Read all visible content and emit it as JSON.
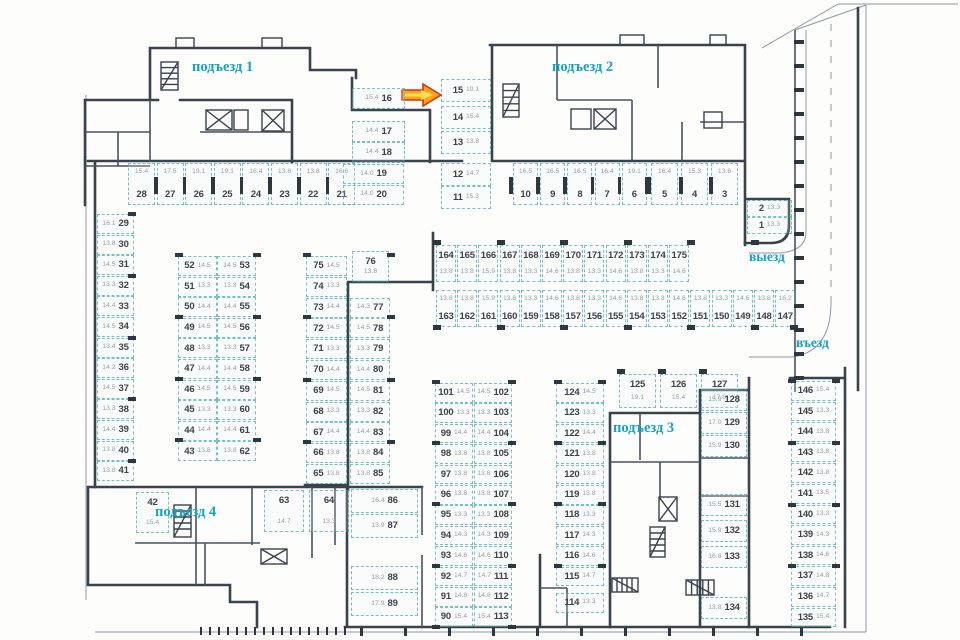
{
  "labels": {
    "entrance1": "подъезд 1",
    "entrance2": "подъезд 2",
    "entrance3": "подъезд 3",
    "entrance4": "подъезд 4",
    "exit": "выезд",
    "entry": "въезд"
  },
  "colors": {
    "wall": "#3a424e",
    "spot_border": "rgba(38,160,164,.62)",
    "spot_number": "#3e434b",
    "spot_area": "#99a0a8",
    "label": "#14a3c8",
    "arrow_fill": "#ffa21f",
    "arrow_stroke": "#d03a10"
  },
  "spot_groups": {
    "row_28_21": [
      {
        "n": "28",
        "a": "15.4"
      },
      {
        "n": "27",
        "a": "17.5"
      },
      {
        "n": "26",
        "a": "19.1"
      },
      {
        "n": "25",
        "a": "19.1"
      },
      {
        "n": "24",
        "a": "16.4"
      },
      {
        "n": "23",
        "a": "13.8"
      },
      {
        "n": "22",
        "a": "13.8"
      },
      {
        "n": "21",
        "a": "16.6"
      }
    ],
    "col_16_18": [
      {
        "n": "16",
        "a": "15.4"
      },
      {
        "n": "17",
        "a": "14.4"
      },
      {
        "n": "18",
        "a": "14.4"
      }
    ],
    "col_19_20": [
      {
        "n": "19",
        "a": "14.0"
      },
      {
        "n": "20",
        "a": "14.0"
      }
    ],
    "col_15_11": [
      {
        "n": "15",
        "a": "19.1"
      },
      {
        "n": "14",
        "a": "15.4"
      },
      {
        "n": "13",
        "a": "13.8"
      },
      {
        "n": "12",
        "a": "14.7"
      },
      {
        "n": "11",
        "a": "15.3"
      }
    ],
    "row_10_6": [
      {
        "n": "10",
        "a": "16.5"
      },
      {
        "n": "9",
        "a": "16.5"
      },
      {
        "n": "8",
        "a": "16.5"
      },
      {
        "n": "7",
        "a": "16.4"
      },
      {
        "n": "6",
        "a": "19.1"
      }
    ],
    "row_5_3": [
      {
        "n": "5",
        "a": "16.4"
      },
      {
        "n": "4",
        "a": "15.3"
      },
      {
        "n": "3",
        "a": "13.6"
      }
    ],
    "col_2_1": [
      {
        "n": "2",
        "a": "13.3"
      },
      {
        "n": "1",
        "a": "13.3"
      }
    ],
    "col_29_41": [
      {
        "n": "29",
        "a": "16.1"
      },
      {
        "n": "30",
        "a": "13.8"
      },
      {
        "n": "31",
        "a": "14.5"
      },
      {
        "n": "32",
        "a": "13.3"
      },
      {
        "n": "33",
        "a": "14.4"
      },
      {
        "n": "34",
        "a": "14.5"
      },
      {
        "n": "35",
        "a": "13.4"
      },
      {
        "n": "36",
        "a": "14.2"
      },
      {
        "n": "37",
        "a": "14.5"
      },
      {
        "n": "38",
        "a": "13.3"
      },
      {
        "n": "39",
        "a": "14.4"
      },
      {
        "n": "40",
        "a": "13.8"
      },
      {
        "n": "41",
        "a": "13.8"
      }
    ],
    "col_52_43": [
      {
        "n": "52",
        "a": "14.5"
      },
      {
        "n": "51",
        "a": "13.3"
      },
      {
        "n": "50",
        "a": "14.4"
      },
      {
        "n": "49",
        "a": "14.5"
      },
      {
        "n": "48",
        "a": "13.3"
      },
      {
        "n": "47",
        "a": "14.4"
      },
      {
        "n": "46",
        "a": "14.5"
      },
      {
        "n": "45",
        "a": "13.3"
      },
      {
        "n": "44",
        "a": "14.4"
      },
      {
        "n": "43",
        "a": "13.8"
      }
    ],
    "col_53_62": [
      {
        "n": "53",
        "a": "14.5"
      },
      {
        "n": "54",
        "a": "13.3"
      },
      {
        "n": "55",
        "a": "14.4"
      },
      {
        "n": "56",
        "a": "14.5"
      },
      {
        "n": "57",
        "a": "13.3"
      },
      {
        "n": "58",
        "a": "14.4"
      },
      {
        "n": "59",
        "a": "14.5"
      },
      {
        "n": "60",
        "a": "13.3"
      },
      {
        "n": "61",
        "a": "14.4"
      },
      {
        "n": "62",
        "a": "13.8"
      }
    ],
    "col_75_65": [
      {
        "n": "75",
        "a": "14.5"
      },
      {
        "n": "74",
        "a": "13.3"
      },
      {
        "n": "73",
        "a": "14.4"
      },
      {
        "n": "72",
        "a": "14.5"
      },
      {
        "n": "71",
        "a": "13.3"
      },
      {
        "n": "70",
        "a": "14.4"
      },
      {
        "n": "69",
        "a": "14.5"
      },
      {
        "n": "68",
        "a": "13.3"
      },
      {
        "n": "67",
        "a": "14.4"
      },
      {
        "n": "66",
        "a": "13.8"
      },
      {
        "n": "65",
        "a": "13.8"
      }
    ],
    "box_76": [
      {
        "n": "76",
        "a": "13.8"
      }
    ],
    "col_77_85": [
      {
        "n": "77",
        "a": "14.3"
      },
      {
        "n": "78",
        "a": "14.5"
      },
      {
        "n": "79",
        "a": "13.3"
      },
      {
        "n": "80",
        "a": "14.4"
      },
      {
        "n": "81",
        "a": "14.5"
      },
      {
        "n": "82",
        "a": "13.3"
      },
      {
        "n": "83",
        "a": "14.4"
      },
      {
        "n": "84",
        "a": "13.8"
      },
      {
        "n": "85",
        "a": "13.8"
      }
    ],
    "row_164_175": [
      {
        "n": "164",
        "a": "13.8"
      },
      {
        "n": "165",
        "a": "13.8"
      },
      {
        "n": "166",
        "a": "15.9"
      },
      {
        "n": "167",
        "a": "13.8"
      },
      {
        "n": "168",
        "a": "13.3"
      },
      {
        "n": "169",
        "a": "14.6"
      },
      {
        "n": "170",
        "a": "13.8"
      },
      {
        "n": "171",
        "a": "13.3"
      },
      {
        "n": "172",
        "a": "14.6"
      },
      {
        "n": "173",
        "a": "13.8"
      },
      {
        "n": "174",
        "a": "13.3"
      },
      {
        "n": "175",
        "a": "14.6"
      }
    ],
    "row_163_147": [
      {
        "n": "163",
        "a": "13.8"
      },
      {
        "n": "162",
        "a": "13.8"
      },
      {
        "n": "161",
        "a": "15.9"
      },
      {
        "n": "160",
        "a": "13.8"
      },
      {
        "n": "159",
        "a": "13.3"
      },
      {
        "n": "158",
        "a": "14.6"
      },
      {
        "n": "157",
        "a": "13.8"
      },
      {
        "n": "156",
        "a": "13.3"
      },
      {
        "n": "155",
        "a": "14.6"
      },
      {
        "n": "154",
        "a": "13.8"
      },
      {
        "n": "153",
        "a": "13.3"
      },
      {
        "n": "152",
        "a": "14.6"
      },
      {
        "n": "151",
        "a": "13.8"
      },
      {
        "n": "150",
        "a": "13.3"
      },
      {
        "n": "149",
        "a": "14.6"
      },
      {
        "n": "148",
        "a": "13.8"
      },
      {
        "n": "147",
        "a": "16.2"
      }
    ],
    "col_101_90": [
      {
        "n": "101",
        "a": "14.5"
      },
      {
        "n": "100",
        "a": "13.3"
      },
      {
        "n": "99",
        "a": "14.4"
      },
      {
        "n": "98",
        "a": "13.8"
      },
      {
        "n": "97",
        "a": "13.8"
      },
      {
        "n": "96",
        "a": "13.8"
      },
      {
        "n": "95",
        "a": "13.3"
      },
      {
        "n": "94",
        "a": "14.3"
      },
      {
        "n": "93",
        "a": "14.6"
      },
      {
        "n": "92",
        "a": "14.7"
      },
      {
        "n": "91",
        "a": "14.8"
      },
      {
        "n": "90",
        "a": "15.4"
      }
    ],
    "col_102_113": [
      {
        "n": "102",
        "a": "14.5"
      },
      {
        "n": "103",
        "a": "13.3"
      },
      {
        "n": "104",
        "a": "14.4"
      },
      {
        "n": "105",
        "a": "13.8"
      },
      {
        "n": "106",
        "a": "13.8"
      },
      {
        "n": "107",
        "a": "13.8"
      },
      {
        "n": "108",
        "a": "13.3"
      },
      {
        "n": "109",
        "a": "14.3"
      },
      {
        "n": "110",
        "a": "14.6"
      },
      {
        "n": "111",
        "a": "14.7"
      },
      {
        "n": "112",
        "a": "14.8"
      },
      {
        "n": "113",
        "a": "15.4"
      }
    ],
    "col_124_114": [
      {
        "n": "124",
        "a": "14.5"
      },
      {
        "n": "123",
        "a": "13.3"
      },
      {
        "n": "122",
        "a": "14.4"
      },
      {
        "n": "121",
        "a": "13.8"
      },
      {
        "n": "120",
        "a": "13.8"
      },
      {
        "n": "119",
        "a": "13.8"
      },
      {
        "n": "118",
        "a": "13.3"
      },
      {
        "n": "117",
        "a": "14.3"
      },
      {
        "n": "116",
        "a": "14.6"
      },
      {
        "n": "115",
        "a": "14.7"
      },
      {
        "n": "114",
        "a": "13.3"
      }
    ],
    "row_125_127": [
      {
        "n": "125",
        "a": "19.1"
      },
      {
        "n": "126",
        "a": "15.4"
      },
      {
        "n": "127",
        "a": "17.8"
      }
    ],
    "col_128_133": [
      {
        "n": "128",
        "a": "15.9"
      },
      {
        "n": "129",
        "a": "17.0"
      },
      {
        "n": "130",
        "a": "15.9"
      },
      {
        "n": "131",
        "a": "15.5"
      },
      {
        "n": "132",
        "a": "15.9"
      },
      {
        "n": "133",
        "a": "16.8"
      }
    ],
    "box_134": [
      {
        "n": "134",
        "a": "13.8"
      }
    ],
    "col_146_135": [
      {
        "n": "146",
        "a": "15.4"
      },
      {
        "n": "145",
        "a": "13.3"
      },
      {
        "n": "144",
        "a": "13.8"
      },
      {
        "n": "143",
        "a": "13.8"
      },
      {
        "n": "142",
        "a": "13.8"
      },
      {
        "n": "141",
        "a": "13.5"
      },
      {
        "n": "140",
        "a": "13.3"
      },
      {
        "n": "139",
        "a": "14.3"
      },
      {
        "n": "138",
        "a": "14.6"
      },
      {
        "n": "137",
        "a": "14.8"
      },
      {
        "n": "136",
        "a": "14.7"
      },
      {
        "n": "135",
        "a": "15.4"
      }
    ],
    "col_86_89": [
      {
        "n": "86",
        "a": "16.4"
      },
      {
        "n": "87",
        "a": "13.9"
      },
      {
        "n": "88",
        "a": "18.2"
      },
      {
        "n": "89",
        "a": "17.9"
      }
    ],
    "row_63_64": [
      {
        "n": "63",
        "a": "14.7"
      },
      {
        "n": "64",
        "a": "13.3"
      }
    ],
    "box_42": [
      {
        "n": "42",
        "a": "15.4"
      }
    ]
  }
}
